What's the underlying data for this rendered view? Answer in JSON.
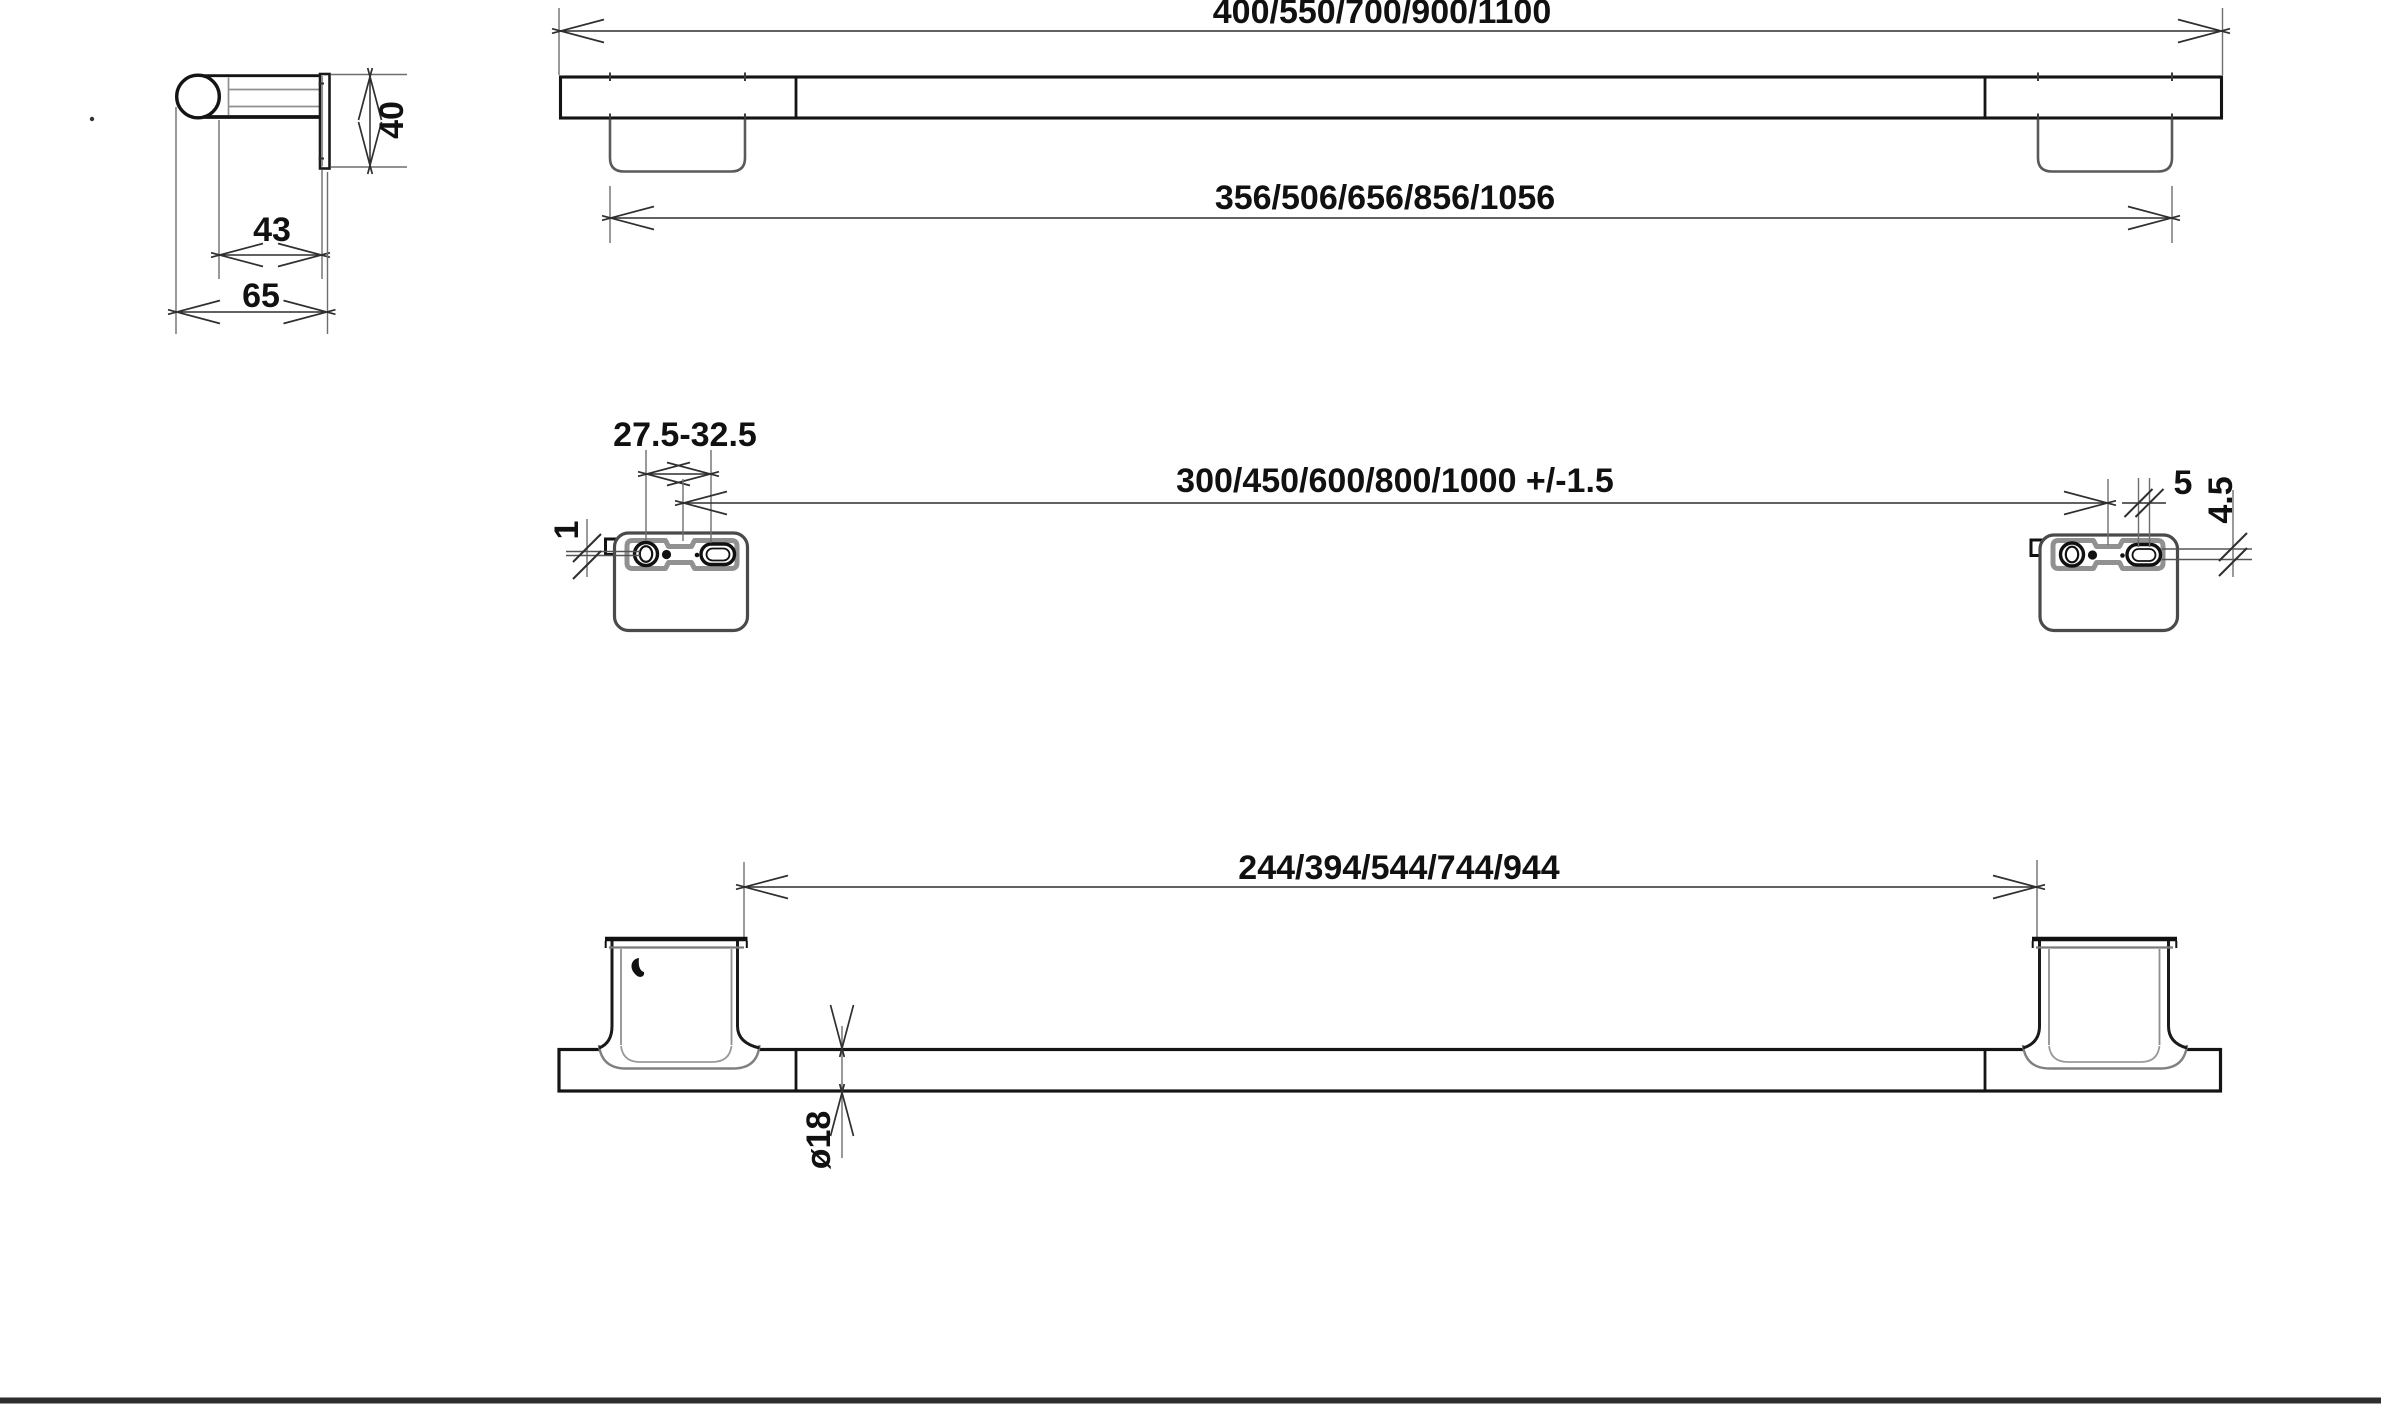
{
  "colors": {
    "background": "#ffffff",
    "main_line": "#141414",
    "secondary_line": "#8f8f8f",
    "bracket_outline": "#4a4a4a",
    "plate_band": "#919191",
    "dimension_line": "#2f2f2f",
    "extension_line": "#6e6e6e",
    "text": "#111111",
    "footer_rule": "#2e2e2e"
  },
  "labels": {
    "profile": {
      "height": "40",
      "bar_depth": "43",
      "total_depth": "65"
    },
    "front": {
      "overall_length": "400/550/700/900/1100",
      "foot_outer_span": "356/506/656/856/1056"
    },
    "mounting": {
      "screw_slot_range": "27.5-32.5",
      "hole_spacing": "300/450/600/800/1000 +/-1.5",
      "wall_gap": "1",
      "slot_width": "5",
      "slot_offset": "4.5"
    },
    "bottom": {
      "foot_inner_span": "244/394/544/744/944",
      "bar_diameter": "ø18"
    }
  }
}
